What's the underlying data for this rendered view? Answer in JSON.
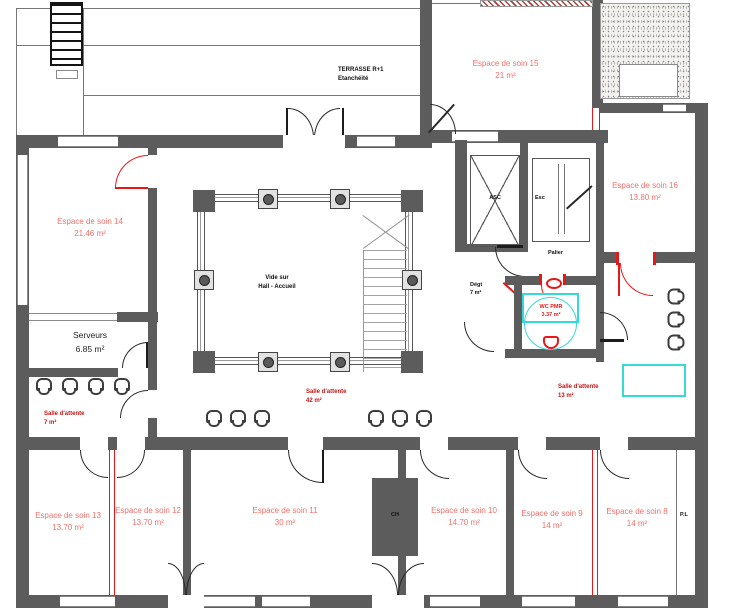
{
  "colors": {
    "wall": "#5c5c5c",
    "room_label": "#f2706b",
    "waiting_label": "#c41414",
    "accent_red": "#e81818",
    "cyan": "#35d9d9"
  },
  "rooms": {
    "soin14": {
      "name": "Espace de soin 14",
      "area": "21.46 m²"
    },
    "soin15": {
      "name": "Espace de soin 15",
      "area": "21 m²"
    },
    "soin16": {
      "name": "Espace de soin 16",
      "area": "13.80 m²"
    },
    "soin13": {
      "name": "Espace de soin 13",
      "area": "13.70 m²"
    },
    "soin12": {
      "name": "Espace de soin 12",
      "area": "13.70 m²"
    },
    "soin11": {
      "name": "Espace de soin 11",
      "area": "30 m²"
    },
    "soin10": {
      "name": "Espace de soin 10",
      "area": "14.70 m²"
    },
    "soin9": {
      "name": "Espace de soin 9",
      "area": "14 m²"
    },
    "soin8": {
      "name": "Espace de soin 8",
      "area": "14 m²"
    },
    "serveurs": {
      "name": "Serveurs",
      "area": "6.85 m²"
    },
    "attente_left": {
      "name": "Salle d'attente",
      "area": "7 m²"
    },
    "attente_center": {
      "name": "Salle d'attente",
      "area": "42 m²"
    },
    "attente_right": {
      "name": "Salle d'attente",
      "area": "13 m²"
    },
    "degagement": {
      "name": "Dégt",
      "area": "7 m²"
    },
    "wc_pmr": {
      "name": "WC PMR",
      "area": "3.37 m²"
    }
  },
  "labels": {
    "terrasse_line1": "TERRASSE R+1",
    "terrasse_line2": "Etanchéité",
    "vide_line1": "Vide sur",
    "vide_line2": "Hall - Accueil",
    "asc": "ASC",
    "esc": "Esc",
    "palier": "Palier",
    "ch": "CH",
    "pl": "P.L"
  }
}
